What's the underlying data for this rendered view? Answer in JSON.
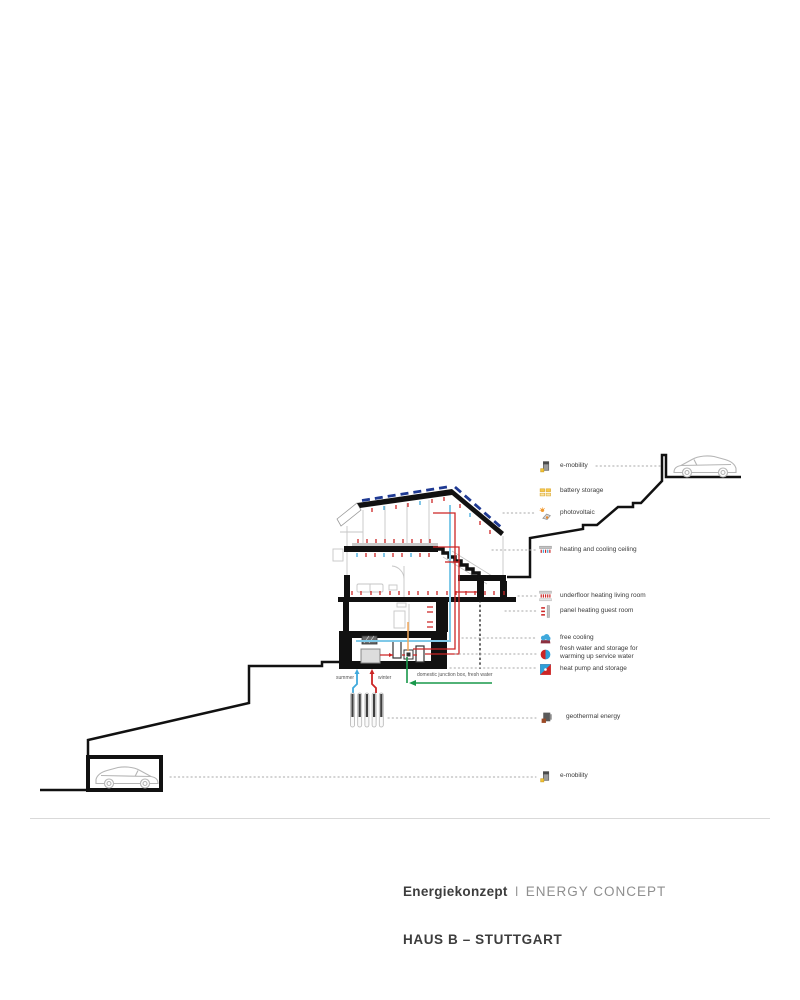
{
  "legend": {
    "items": [
      {
        "icon": "e-mobility-icon",
        "label": "e-mobility"
      },
      {
        "icon": "battery-storage-icon",
        "label": "battery storage"
      },
      {
        "icon": "photovoltaic-icon",
        "label": "photovoltaic"
      },
      {
        "icon": "heating-cooling-ceiling-icon",
        "label": "heating and cooling ceiling"
      },
      {
        "icon": "underfloor-heating-icon",
        "label": "underfloor heating living room"
      },
      {
        "icon": "panel-heating-icon",
        "label": "panel heating guest room"
      },
      {
        "icon": "free-cooling-icon",
        "label": "free cooling"
      },
      {
        "icon": "fresh-water-storage-icon",
        "label": "fresh water and storage for\nwarming up service water"
      },
      {
        "icon": "heat-pump-storage-icon",
        "label": "heat pump and storage"
      },
      {
        "icon": "geothermal-energy-icon",
        "label": "geothermal energy"
      },
      {
        "icon": "e-mobility-icon",
        "label": "e-mobility"
      }
    ]
  },
  "drawing": {
    "summer_label": "summer",
    "winter_label": "winter",
    "junction_label": "domestic junction box, fresh water"
  },
  "footer": {
    "title_de": "Energiekonzept",
    "title_separator": "I",
    "title_en": "ENERGY CONCEPT",
    "project": "HAUS B – STUTTGART"
  },
  "colors": {
    "heating_red": "#cc2525",
    "cooling_blue": "#3fa9dc",
    "pv_blue": "#1f3a93",
    "fresh_water_green": "#18984a",
    "structure_black": "#111111"
  }
}
